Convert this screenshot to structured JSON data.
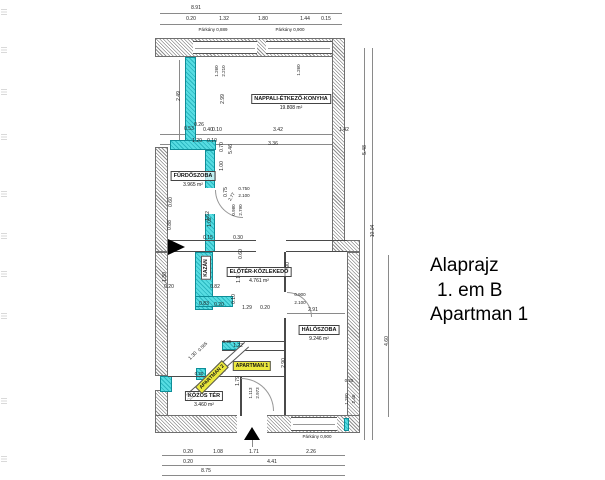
{
  "title_block": {
    "line1": "Alaprajz",
    "line2": "1. em B",
    "line3": "Apartman 1"
  },
  "rooms": [
    {
      "name": "NAPPALI-ÉTKEZŐ-KONYHA",
      "area": "19.808 m²",
      "x": 291,
      "y": 99
    },
    {
      "name": "FÜRDŐSZOBA",
      "area": "3.965 m²",
      "x": 193,
      "y": 176
    },
    {
      "name": "ELŐTÉR-KÖZLEKEDŐ",
      "area": "4.761 m²",
      "x": 259,
      "y": 272
    },
    {
      "name": "HÁLÓSZOBA",
      "area": "9.246 m²",
      "x": 319,
      "y": 330
    },
    {
      "name": "KÖZÖS TÉR",
      "area": "3.460 m²",
      "x": 204,
      "y": 396
    }
  ],
  "tags": [
    {
      "label": "KAZÁN",
      "x": 206,
      "y": 268,
      "r": -90,
      "kind": "box"
    },
    {
      "label": "APARTMAN 1",
      "x": 252,
      "y": 366,
      "r": 0,
      "kind": "highlight"
    },
    {
      "label": "APARTMAN 2",
      "x": 212,
      "y": 377,
      "r": -45,
      "kind": "highlight"
    }
  ],
  "dims": [
    {
      "t": "8.91",
      "x": 196,
      "y": 8
    },
    {
      "t": "0.20",
      "x": 191,
      "y": 19
    },
    {
      "t": "1.32",
      "x": 224,
      "y": 19
    },
    {
      "t": "1.80",
      "x": 263,
      "y": 19
    },
    {
      "t": "1.44",
      "x": 305,
      "y": 19
    },
    {
      "t": "0.15",
      "x": 326,
      "y": 19
    },
    {
      "t": "Párkány 0,889",
      "x": 213,
      "y": 30,
      "s": 4.5
    },
    {
      "t": "Párkány 0,900",
      "x": 290,
      "y": 30,
      "s": 4.5
    },
    {
      "t": "1.260",
      "x": 217,
      "y": 71,
      "r": -90,
      "s": 4.5
    },
    {
      "t": "2.210",
      "x": 224,
      "y": 71,
      "r": -90,
      "s": 4.5
    },
    {
      "t": "1.260",
      "x": 299,
      "y": 70,
      "r": -90,
      "s": 4.5
    },
    {
      "t": "2.49",
      "x": 179,
      "y": 96,
      "r": -90
    },
    {
      "t": "2.99",
      "x": 223,
      "y": 99,
      "r": -90
    },
    {
      "t": "0.53",
      "x": 189,
      "y": 129
    },
    {
      "t": "0.26",
      "x": 199,
      "y": 125
    },
    {
      "t": "0.40",
      "x": 208,
      "y": 130
    },
    {
      "t": "0.10",
      "x": 217,
      "y": 130
    },
    {
      "t": "3.42",
      "x": 278,
      "y": 130
    },
    {
      "t": "1.42",
      "x": 344,
      "y": 130
    },
    {
      "t": "1.20",
      "x": 197,
      "y": 141
    },
    {
      "t": "0.10",
      "x": 212,
      "y": 141
    },
    {
      "t": "0.70",
      "x": 222,
      "y": 147,
      "r": -90
    },
    {
      "t": "5.46",
      "x": 231,
      "y": 149,
      "r": -90
    },
    {
      "t": "3.36",
      "x": 273,
      "y": 144
    },
    {
      "t": "5.48",
      "x": 365,
      "y": 150,
      "r": -90
    },
    {
      "t": "10.04",
      "x": 373,
      "y": 231,
      "r": -90
    },
    {
      "t": "1.00",
      "x": 222,
      "y": 166,
      "r": -90
    },
    {
      "t": "0.75",
      "x": 226,
      "y": 192,
      "r": -90
    },
    {
      "t": "2.77",
      "x": 232,
      "y": 197,
      "r": -60,
      "s": 4.5
    },
    {
      "t": "0.750",
      "x": 244,
      "y": 189,
      "s": 4.5
    },
    {
      "t": "2.100",
      "x": 244,
      "y": 196,
      "s": 4.5
    },
    {
      "t": "0.60",
      "x": 171,
      "y": 202,
      "r": -90
    },
    {
      "t": "1.62",
      "x": 208,
      "y": 216,
      "r": -90
    },
    {
      "t": "0.980",
      "x": 234,
      "y": 210,
      "r": -90,
      "s": 4.5
    },
    {
      "t": "2.790",
      "x": 241,
      "y": 210,
      "r": -90,
      "s": 4.5
    },
    {
      "t": "0.88",
      "x": 170,
      "y": 225,
      "r": -90
    },
    {
      "t": "1.02",
      "x": 210,
      "y": 222,
      "r": -90
    },
    {
      "t": "0.15",
      "x": 208,
      "y": 238
    },
    {
      "t": "0.30",
      "x": 238,
      "y": 238
    },
    {
      "t": "0.60",
      "x": 241,
      "y": 254,
      "r": -90
    },
    {
      "t": "1.30",
      "x": 165,
      "y": 277,
      "r": -90
    },
    {
      "t": "0.20",
      "x": 169,
      "y": 287
    },
    {
      "t": "0.82",
      "x": 215,
      "y": 287
    },
    {
      "t": "1.10",
      "x": 239,
      "y": 278,
      "r": -90
    },
    {
      "t": "0.90",
      "x": 288,
      "y": 267,
      "r": -90
    },
    {
      "t": "0.10",
      "x": 234,
      "y": 299,
      "r": -90
    },
    {
      "t": "0.83",
      "x": 204,
      "y": 304
    },
    {
      "t": "0.20",
      "x": 219,
      "y": 305
    },
    {
      "t": "1.29",
      "x": 247,
      "y": 308
    },
    {
      "t": "0.20",
      "x": 265,
      "y": 308
    },
    {
      "t": "0.900",
      "x": 300,
      "y": 295,
      "s": 4.5
    },
    {
      "t": "2.100",
      "x": 300,
      "y": 303,
      "s": 4.5
    },
    {
      "t": "2.91",
      "x": 313,
      "y": 310
    },
    {
      "t": "2.90",
      "x": 284,
      "y": 363,
      "r": -90
    },
    {
      "t": "0.25",
      "x": 227,
      "y": 342,
      "s": 4.5
    },
    {
      "t": "1.22",
      "x": 238,
      "y": 346
    },
    {
      "t": "0.565",
      "x": 203,
      "y": 347,
      "r": -45,
      "s": 4.5
    },
    {
      "t": "1.30",
      "x": 193,
      "y": 356,
      "r": -45
    },
    {
      "t": "1.34",
      "x": 224,
      "y": 371,
      "r": -45
    },
    {
      "t": "1.79",
      "x": 238,
      "y": 381,
      "r": -90
    },
    {
      "t": "1.113",
      "x": 251,
      "y": 393,
      "r": -90,
      "s": 4.5
    },
    {
      "t": "2.973",
      "x": 258,
      "y": 393,
      "r": -90,
      "s": 4.5
    },
    {
      "t": "0.87",
      "x": 190,
      "y": 396,
      "r": -90
    },
    {
      "t": "0.20",
      "x": 199,
      "y": 374,
      "s": 4.5
    },
    {
      "t": "0.25",
      "x": 349,
      "y": 381,
      "s": 4.5
    },
    {
      "t": "1.260",
      "x": 347,
      "y": 399,
      "r": -90,
      "s": 4.5
    },
    {
      "t": "2.40",
      "x": 354,
      "y": 399,
      "r": -90,
      "s": 4.5
    },
    {
      "t": "4.60",
      "x": 387,
      "y": 341,
      "r": -90
    },
    {
      "t": "Párkány 0,900",
      "x": 317,
      "y": 437,
      "s": 4.5
    },
    {
      "t": "0.20",
      "x": 188,
      "y": 452
    },
    {
      "t": "1.08",
      "x": 218,
      "y": 452
    },
    {
      "t": "1.71",
      "x": 254,
      "y": 452
    },
    {
      "t": "2.26",
      "x": 311,
      "y": 452
    },
    {
      "t": "0.20",
      "x": 188,
      "y": 462
    },
    {
      "t": "4.41",
      "x": 272,
      "y": 462
    },
    {
      "t": "8.75",
      "x": 206,
      "y": 471
    }
  ],
  "colors": {
    "wall_highlight": "#57dde2",
    "label_highlight": "#ece93e",
    "line": "#4a4a4a"
  }
}
